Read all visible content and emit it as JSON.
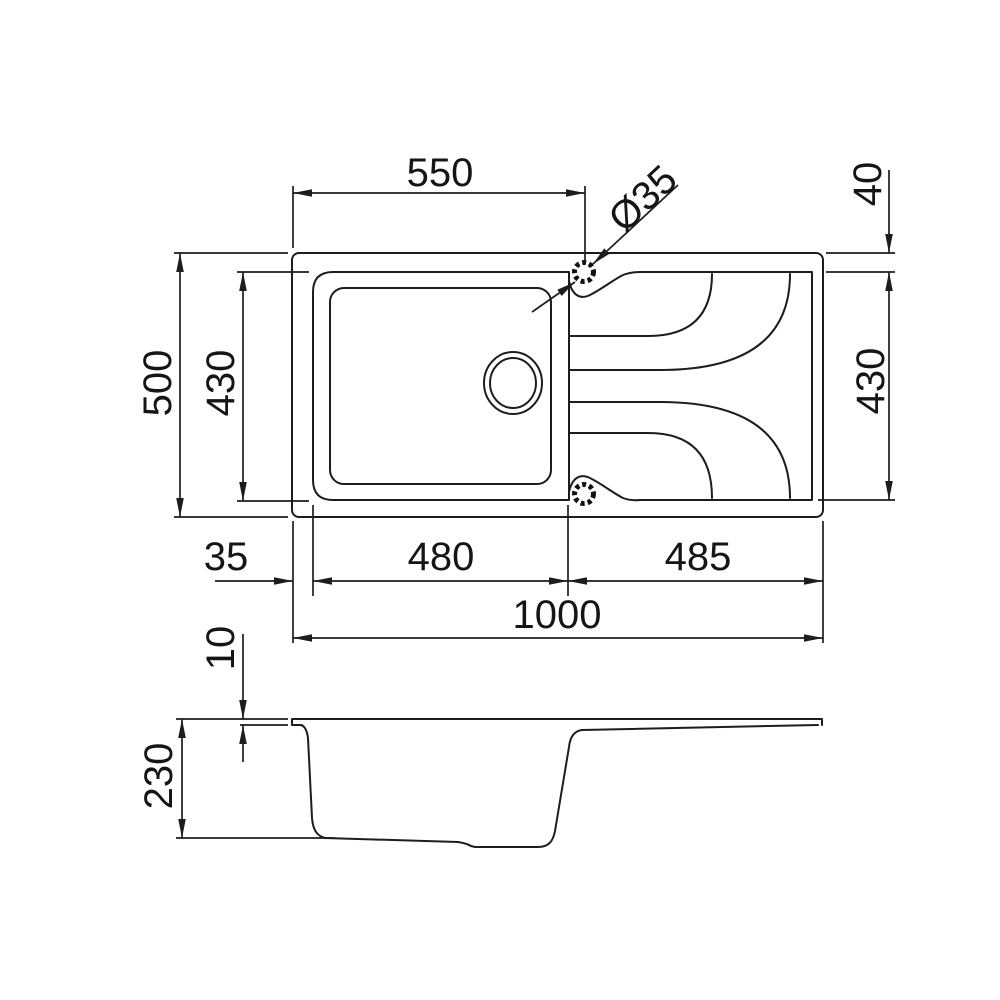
{
  "drawing": {
    "background": "#ffffff",
    "line_color": "#1d1d1d",
    "text_color": "#151515",
    "views": {
      "top_view": "sink plan view",
      "side_view": "sink section profile"
    },
    "features": [
      "outer-rim",
      "bowl",
      "bowl-inner",
      "drain-hole",
      "divider",
      "drainer-grooves",
      "tap-hole-top",
      "tap-hole-bottom"
    ]
  },
  "dims": {
    "d550": {
      "label": "550",
      "orientation": "horizontal"
    },
    "d35dia": {
      "label": "Ø35",
      "orientation": "diagonal"
    },
    "d40": {
      "label": "40",
      "orientation": "vertical"
    },
    "d500": {
      "label": "500",
      "orientation": "vertical"
    },
    "d430l": {
      "label": "430",
      "orientation": "vertical"
    },
    "d430r": {
      "label": "430",
      "orientation": "vertical"
    },
    "d35": {
      "label": "35",
      "orientation": "horizontal"
    },
    "d480": {
      "label": "480",
      "orientation": "horizontal"
    },
    "d485": {
      "label": "485",
      "orientation": "horizontal"
    },
    "d1000": {
      "label": "1000",
      "orientation": "horizontal"
    },
    "d10": {
      "label": "10",
      "orientation": "vertical"
    },
    "d230": {
      "label": "230",
      "orientation": "vertical"
    }
  }
}
